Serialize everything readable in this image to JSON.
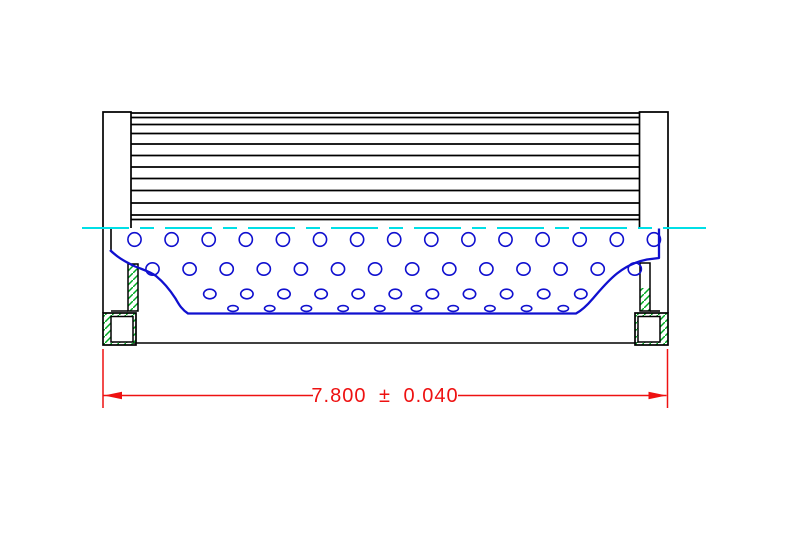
{
  "colors": {
    "background": "#ffffff",
    "outline": "#000000",
    "media_blue": "#1010cf",
    "centerline_cyan": "#00dfe6",
    "hatch_green": "#00aa22",
    "dimension_red": "#ee1111"
  },
  "drawing": {
    "canvas": {
      "width": 789,
      "height": 546
    },
    "centerline": {
      "y": 228,
      "x1": 82,
      "x2": 706,
      "dash": "47 11 14 11",
      "width": 2
    },
    "media_block": {
      "x1": 131,
      "x2": 639.5,
      "wrap_lines_y": [
        113,
        117.5,
        124.5,
        133.5,
        144,
        155.5,
        167,
        178.5,
        190.5,
        203,
        215,
        219.5
      ],
      "line_width": 1.7
    },
    "flanges": {
      "left": {
        "x1": 103,
        "x2": 131,
        "top": 112,
        "bottom": 228
      },
      "right": {
        "x1": 639.5,
        "x2": 668,
        "top": 112,
        "bottom": 228
      }
    },
    "section_lines": [
      [
        103,
        228,
        103,
        313
      ],
      [
        111,
        228.5,
        111,
        251
      ],
      [
        111,
        311,
        128,
        311
      ],
      [
        668,
        228,
        668,
        313
      ],
      [
        650,
        311,
        660,
        311
      ],
      [
        133,
        343,
        637,
        343
      ]
    ],
    "seal_strips": {
      "left": {
        "rect": [
          128,
          264,
          10,
          47
        ],
        "hatch": [
          128,
          264,
          10,
          47
        ]
      },
      "right": {
        "rect": [
          640,
          263,
          10,
          48
        ],
        "hatch": [
          640,
          288,
          10,
          23
        ]
      }
    },
    "cap_boxes": {
      "left": {
        "outer": [
          103,
          313,
          33,
          32
        ],
        "inner": [
          111,
          316.5,
          22,
          25.5
        ]
      },
      "right": {
        "outer": [
          635,
          313,
          33,
          32
        ],
        "inner": [
          638,
          316.5,
          22,
          25.5
        ]
      }
    },
    "core": {
      "curve_path": "M 110 250 C 117 257 124 261 133 265.5 C 142 269.5 149 271 156 276 C 164 282.5 170 290 175.5 298.5 C 178.5 303.5 181 309 188 313.5 L 576 313.5 C 582.5 310 587 305.5 592.5 299 C 599.5 291 607 281.5 617 273.5 C 627 265.5 637 261.5 647 259.5 L 659 258 L 659 228.5",
      "curve_width": 2.3,
      "hole_rows": [
        {
          "cy": 239.5,
          "rx": 6.6,
          "ry": 6.8,
          "x0": 134.5,
          "dx": 37.1,
          "n": 15
        },
        {
          "cy": 269,
          "rx": 6.6,
          "ry": 6.2,
          "x0": 152.5,
          "dx": 37.1,
          "n": 14
        },
        {
          "cy": 294,
          "rx": 6.2,
          "ry": 4.8,
          "x0": 209.8,
          "dx": 37.1,
          "n": 11
        },
        {
          "cy": 308.5,
          "rx": 5.2,
          "ry": 2.9,
          "x0": 233,
          "dx": 36.7,
          "n": 10
        }
      ],
      "hole_line_width": 1.6
    },
    "dimension": {
      "label": "7.800 ± 0.040",
      "line_y": 395.5,
      "segments": [
        [
          103,
          313
        ],
        [
          458,
          666.5
        ]
      ],
      "ext_lines": [
        [
          103,
          349,
          103,
          408
        ],
        [
          667.5,
          349,
          667.5,
          408
        ]
      ],
      "arrow_left": "104,395.5 122,391.8 122,399.2",
      "arrow_right": "666.5,395.5 648.5,391.8 648.5,399.2",
      "text_x": 385,
      "text_y": 402,
      "font_size": 20,
      "line_width": 1.5
    }
  }
}
